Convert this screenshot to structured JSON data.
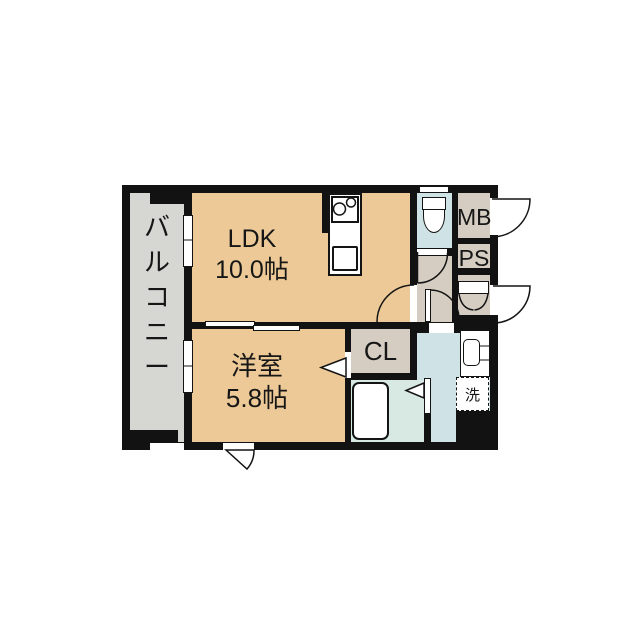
{
  "palette": {
    "wall": "#121212",
    "tan": "#ecc997",
    "balcony": "#d6d6d2",
    "beige": "#d5cdc1",
    "blue": "#cfe3e7",
    "bathgreen": "#d8e8e2",
    "paper": "#ffffff"
  },
  "rooms": {
    "balcony": "バ\nル\nコ\nニ\nー",
    "ldk": "LDK\n10.0帖",
    "western": "洋室\n5.8帖",
    "closet": "CL",
    "meter_box": "MB",
    "pipe_space": "PS",
    "washer": "洗"
  }
}
